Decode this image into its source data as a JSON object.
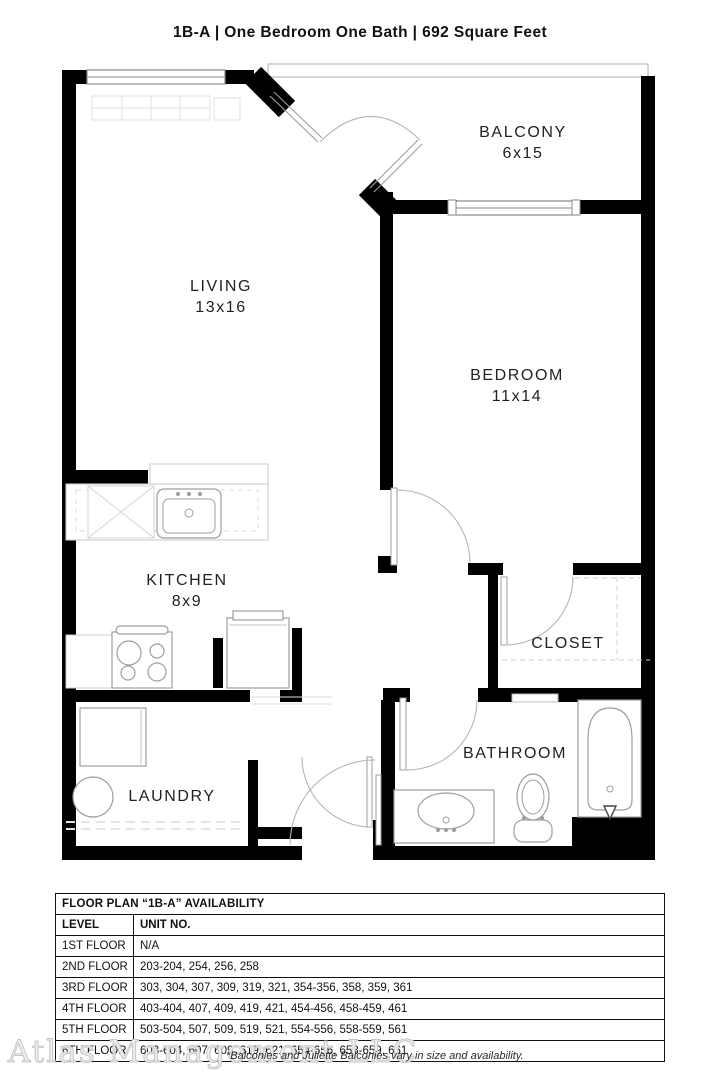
{
  "title": "1B-A  | One Bedroom One Bath |  692 Square Feet",
  "rooms": {
    "balcony": {
      "name": "BALCONY",
      "dims": "6x15"
    },
    "living": {
      "name": "LIVING",
      "dims": "13x16"
    },
    "bedroom": {
      "name": "BEDROOM",
      "dims": "11x14"
    },
    "kitchen": {
      "name": "KITCHEN",
      "dims": "8x9"
    },
    "closet": {
      "name": "CLOSET"
    },
    "bathroom": {
      "name": "BATHROOM"
    },
    "laundry": {
      "name": "LAUNDRY"
    }
  },
  "availability": {
    "title": "FLOOR PLAN “1B-A” AVAILABILITY",
    "columns": {
      "level": "LEVEL",
      "unit": "UNIT NO."
    },
    "rows": [
      {
        "level": "1ST FLOOR",
        "units": "N/A"
      },
      {
        "level": "2ND FLOOR",
        "units": "203-204, 254, 256, 258"
      },
      {
        "level": "3RD FLOOR",
        "units": "303, 304, 307, 309, 319, 321, 354-356, 358, 359, 361"
      },
      {
        "level": "4TH FLOOR",
        "units": "403-404, 407, 409, 419, 421, 454-456, 458-459, 461"
      },
      {
        "level": "5TH FLOOR",
        "units": "503-504, 507, 509, 519, 521, 554-556, 558-559, 561"
      },
      {
        "level": "6TH FLOOR",
        "units": "603-604, 607, 609, 619, 621, 654-656, 658-659, 661"
      }
    ]
  },
  "footer": {
    "watermark": "Atlas Management LLC",
    "note": "*Balconies and Juliette Balconies vary in size and availability."
  },
  "colors": {
    "wall": "#000000",
    "fixture": "#9e9e9e",
    "light_fixture": "#d8d8d8"
  }
}
